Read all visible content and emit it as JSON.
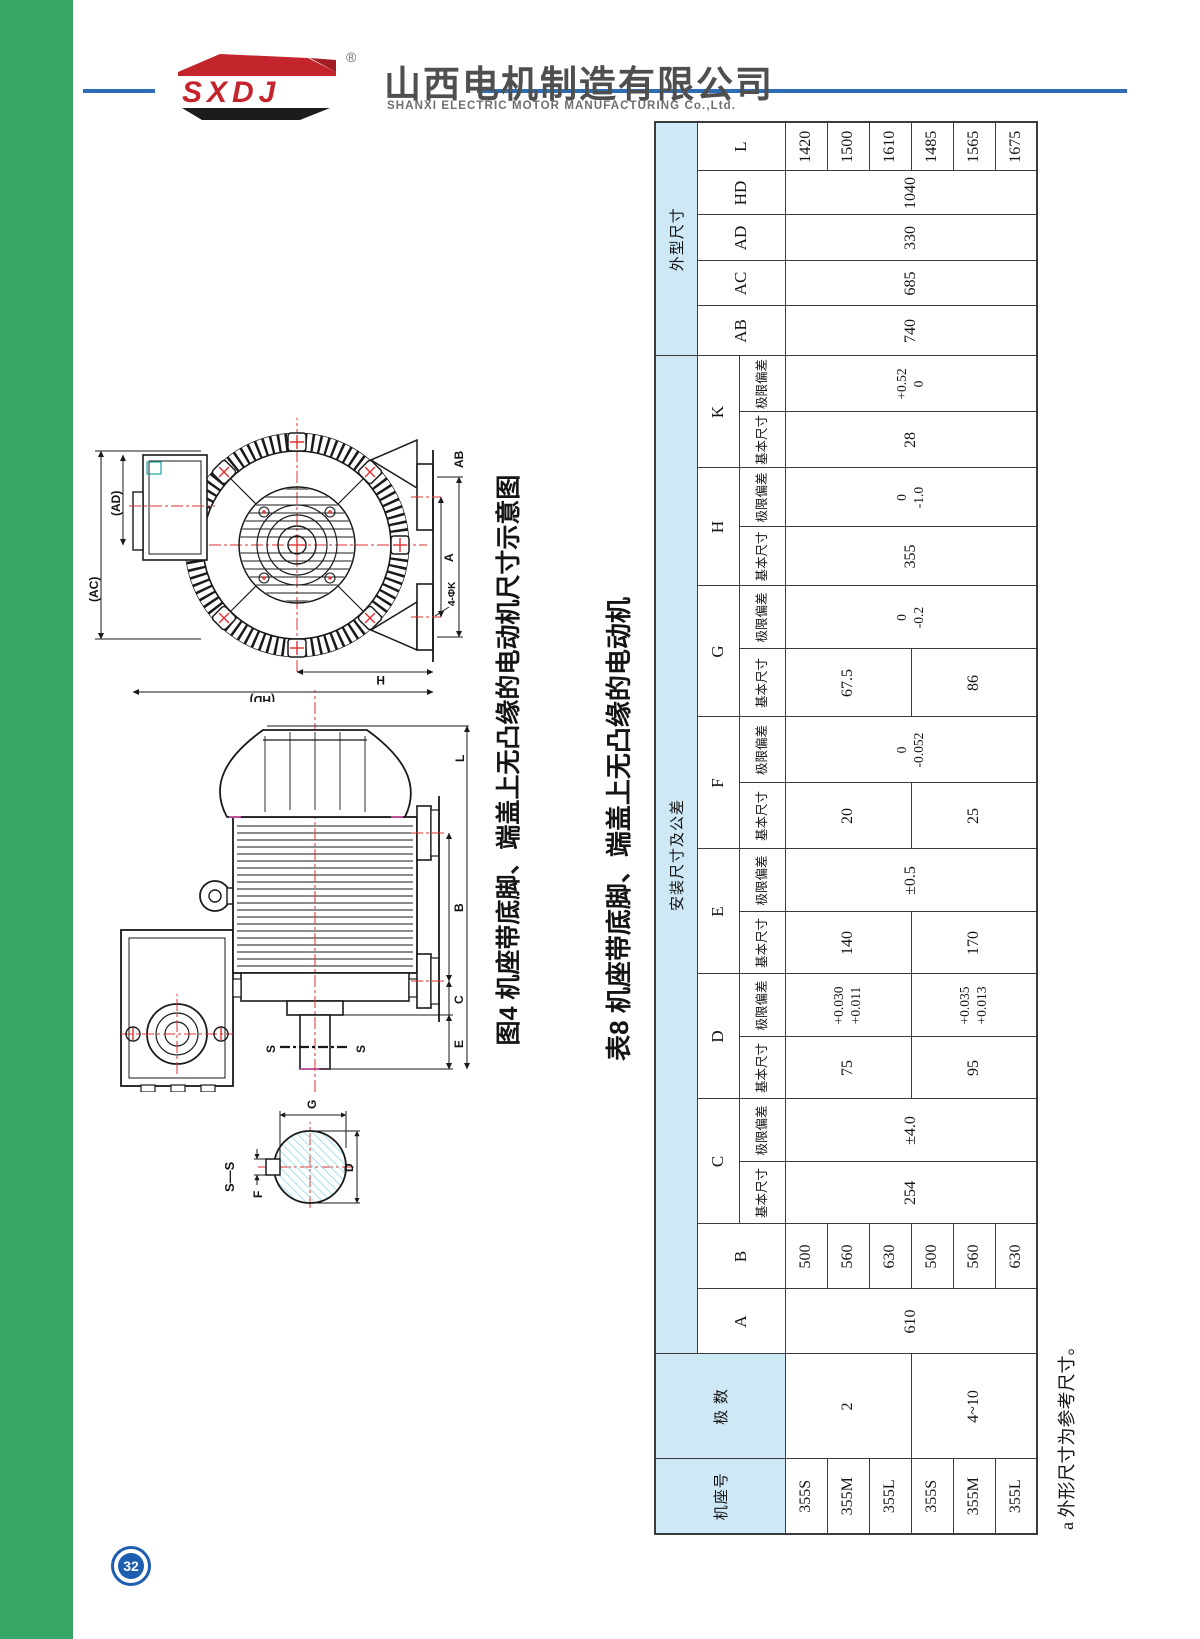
{
  "page": {
    "number": "32",
    "colors": {
      "sidebar_green": "#38a766",
      "accent_blue_line": "#2e6cb3",
      "badge_blue": "#1d5fae",
      "table_header_fill": "#cfe8f6",
      "logo_red": "#c4242b",
      "logo_black": "#1c1c1c"
    }
  },
  "header": {
    "logo_text": "SXDJ",
    "reg_mark": "®",
    "company_cn": "山西电机制造有限公司",
    "company_en": "SHANXI ELECTRIC MOTOR MANUFACTURING Co.,Ltd."
  },
  "figure": {
    "caption": "图4 机座带底脚、端盖上无凸缘的电动机尺寸示意图",
    "labels": {
      "section_title": "S—S",
      "s_upper": "S",
      "s_lower": "S",
      "f": "F",
      "g": "G",
      "d": "D",
      "e": "E",
      "c": "C",
      "b": "B",
      "l": "L",
      "ac": "(AC)",
      "ad": "(AD)",
      "hd": "(HD)",
      "h": "H",
      "a": "A",
      "ab": "AB",
      "k_holes": "4-ΦK"
    }
  },
  "table": {
    "title": "表8 机座带底脚、端盖上无凸缘的电动机",
    "footnote": "a 外形尺寸为参考尺寸。",
    "header": {
      "frame": "机座号",
      "poles": "极 数",
      "install": "安装尺寸及公差",
      "outline": "外型尺寸",
      "basic": "基本尺寸",
      "limit": "极限偏差",
      "cols": {
        "A": "A",
        "B": "B",
        "C": "C",
        "D": "D",
        "E": "E",
        "F": "F",
        "G": "G",
        "H": "H",
        "K": "K",
        "AB": "AB",
        "AC": "AC",
        "AD": "AD",
        "HD": "HD",
        "L": "L"
      }
    },
    "poles": {
      "p2": "2",
      "p4": "4~10"
    },
    "frames": [
      "355S",
      "355M",
      "355L",
      "355S",
      "355M",
      "355L"
    ],
    "A": "610",
    "B": [
      "500",
      "560",
      "630",
      "500",
      "560",
      "630"
    ],
    "C": {
      "basic": "254",
      "limit": "±4.0"
    },
    "D": {
      "basic2": "75",
      "limit2": [
        "+0.030",
        "+0.011"
      ],
      "basic4": "95",
      "limit4": [
        "+0.035",
        "+0.013"
      ]
    },
    "E": {
      "basic2": "140",
      "basic4": "170",
      "limit": "±0.5"
    },
    "F": {
      "basic2": "20",
      "basic4": "25",
      "limit": [
        "0",
        "-0.052"
      ]
    },
    "G": {
      "basic2": "67.5",
      "basic4": "86",
      "limit": [
        "0",
        "-0.2"
      ]
    },
    "H": {
      "basic": "355",
      "limit": [
        "0",
        "-1.0"
      ]
    },
    "K": {
      "basic": "28",
      "limit": [
        "+0.52",
        "0"
      ]
    },
    "AB": "740",
    "AC": "685",
    "AD": "330",
    "HD": "1040",
    "L": [
      "1420",
      "1500",
      "1610",
      "1485",
      "1565",
      "1675"
    ]
  }
}
